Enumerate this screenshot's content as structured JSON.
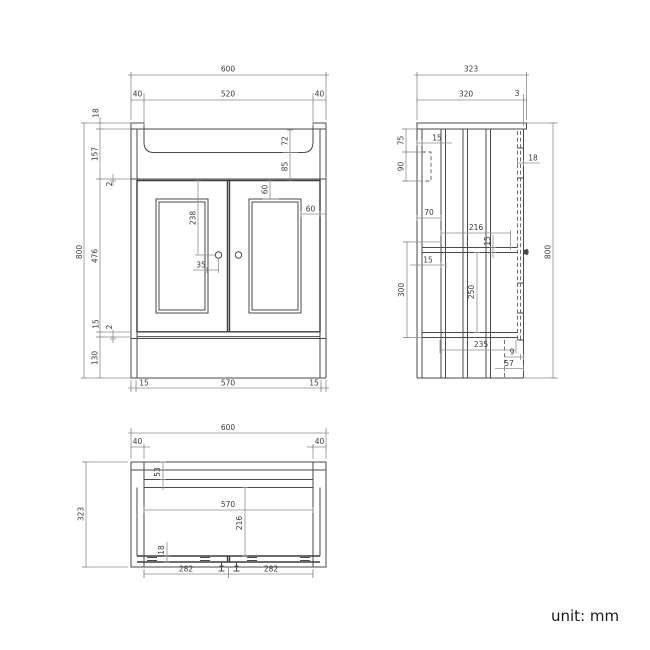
{
  "unit_label": "unit: mm",
  "front": {
    "overall_width": "600",
    "left_upstand": "40",
    "basin_width": "520",
    "right_upstand": "40",
    "overall_height": "800",
    "top_lip": "18",
    "top_section": "157",
    "top_gap": "2",
    "door_height": "476",
    "bottom_rail": "15",
    "bottom_gap": "2",
    "plinth_height": "130",
    "basin_depth": "72",
    "under_basin": "85",
    "frame_top_inset": "60",
    "frame_side_inset": "60",
    "handle_drop": "238",
    "handle_inset": "35",
    "bottom_inset_left": "15",
    "bottom_opening": "570",
    "bottom_inset_right": "15"
  },
  "side": {
    "overall_depth": "323",
    "body_depth": "320",
    "front_overhang": "3",
    "rail_top_offset": "75",
    "rail_height": "90",
    "back_panel_thickness": "15",
    "back_clearance": "70",
    "panel_thickness": "15",
    "interior_depth": "216",
    "shelf_thickness": "15",
    "under_shelf_height": "250",
    "shelf_zone_height": "300",
    "bottom_depth": "235",
    "plinth_lip": "9",
    "plinth_recess": "57",
    "door_thickness": "18",
    "overall_height": "800"
  },
  "plan": {
    "overall_width": "600",
    "left_corner": "40",
    "right_corner": "40",
    "overall_depth": "323",
    "back_rail_depth": "53",
    "inner_width": "570",
    "interior_depth": "216",
    "door_thickness": "18",
    "left_door_width": "282",
    "right_door_width": "282"
  }
}
